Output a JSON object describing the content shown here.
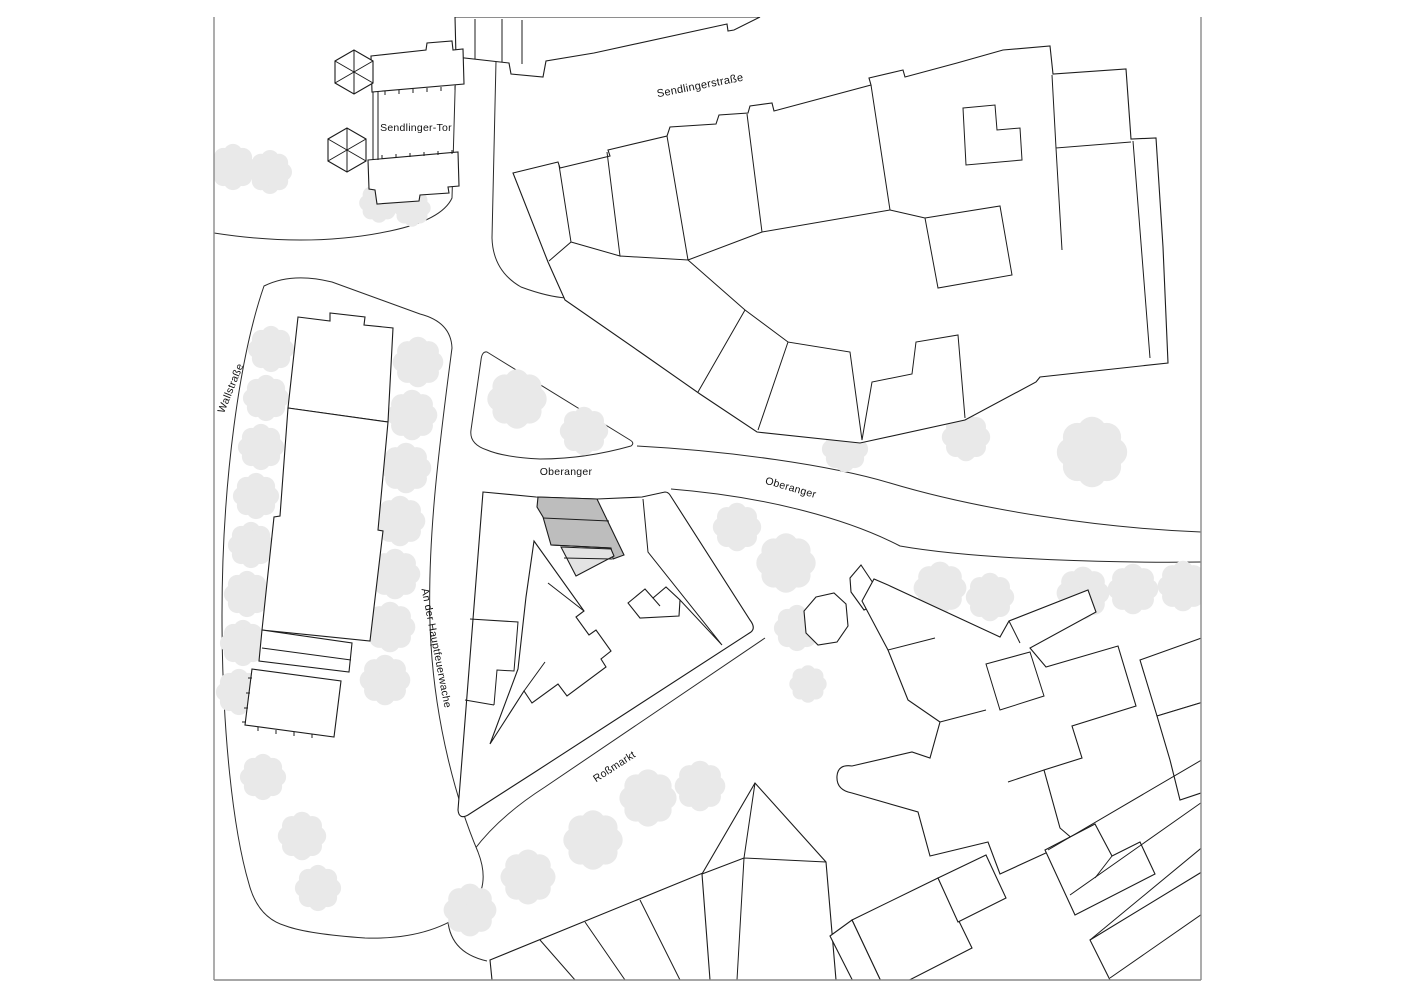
{
  "map": {
    "title": "Site plan Sendlinger Tor / Oberanger",
    "labels": {
      "sendlinger_tor": "Sendlinger-Tor",
      "sendlingerstrasse": "Sendlingerstraße",
      "wallstrasse": "Wallstraße",
      "oberanger_west": "Oberanger",
      "oberanger_east": "Oberanger",
      "an_der_hauptfeuerwache": "An der Hauptfeuerwache",
      "rossmarkt": "Roßmarkt"
    },
    "colors": {
      "line": "#1c1c1c",
      "street": "#2a2a2a",
      "tree": "#e9e9e9",
      "hl-dark": "#bdbdbd",
      "hl-light": "#e3e3e3",
      "frame": "#8a8a8a",
      "bg": "#ffffff"
    }
  }
}
